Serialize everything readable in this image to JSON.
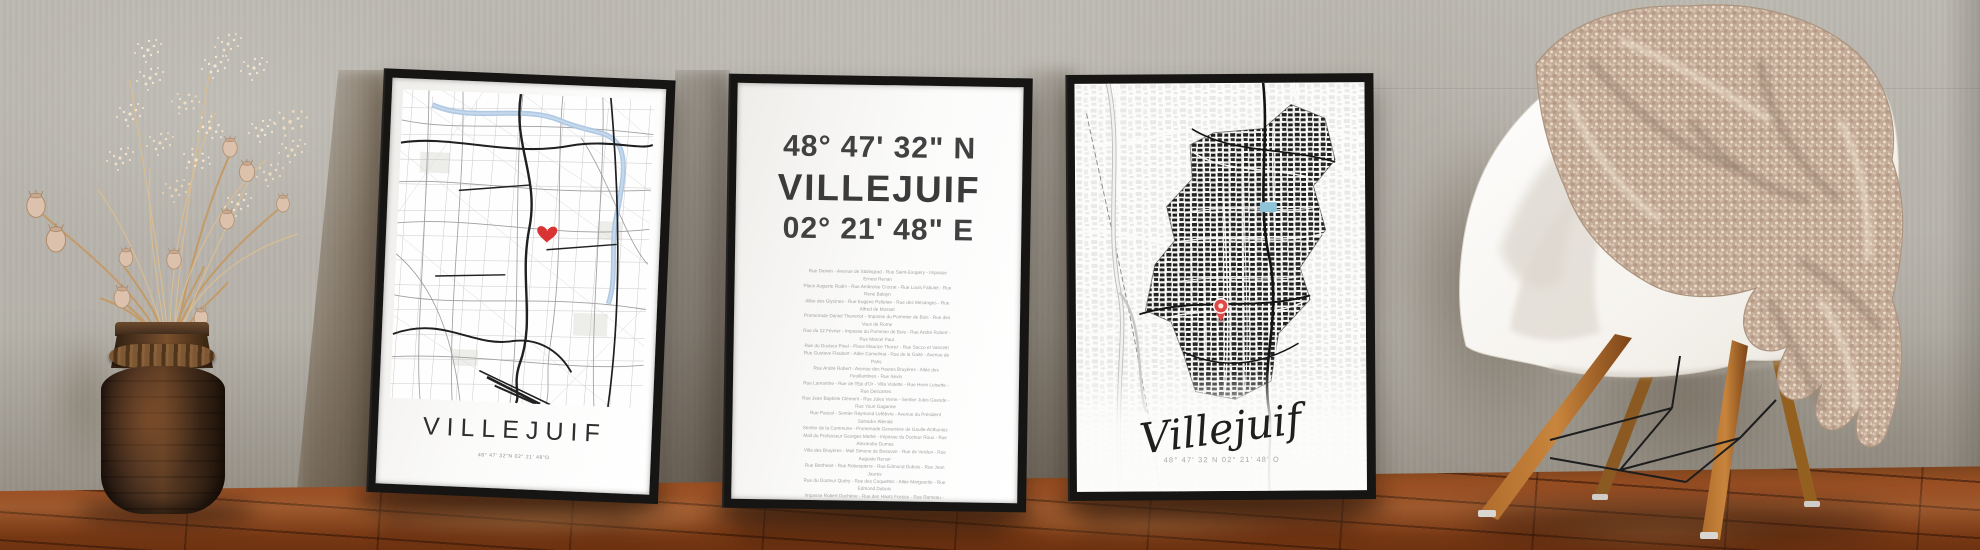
{
  "scene": {
    "caption": "Three framed Villejuif map posters leaning against a concrete wall, dried flowers in a wooden vase, white shell chair with a knit throw blanket on a wooden floor"
  },
  "poster_left": {
    "title": "VILLEJUIF",
    "coordinates": "48° 47' 32\"N 02° 21' 48\"O",
    "marker_icon": "heart-icon",
    "marker_color": "#d93333",
    "river_color": "#abc5e1"
  },
  "poster_center": {
    "latitude": "48° 47' 32\" N",
    "title": "VILLEJUIF",
    "longitude": "02° 21' 48\" E",
    "street_lines": [
      "Rue Darwin - Avenue de Stalingrad - Rue Saint-Exupéry - Impasse Ernest Renan",
      "Place Auguste Rodin - Rue Ambroise Croizat - Rue Louis Fabulet - Rue René Balayn",
      "Allée des Glycines - Rue Eugène Pelletan - Rue des Mésanges - Rue Alfred de Musset",
      "Promenade Daniel Thevenot - Impasse du Pommier de Bois - Rue des Vaux de Rome",
      "Rue du 12 Février - Impasse du Pommier de Bois - Rue André Robert - Rue Marcel Paul",
      "Rue du Docteur Pinel - Place Maurice Thorez - Rue Sacco et Vanzetti",
      "Rue Gustave Flaubert - Allée Camelinat - Rue de la Gaité - Avenue de Paris",
      "Rue André Robert - Avenue des Hautes Bruyères - Allée des Feuillantines - Rue Sévin",
      "Rue Lamartine - Rue de l'Épi d'Or - Villa Violette - Rue Henri Luisette - Rue Descartes",
      "Rue Jean Baptiste Clément - Rue Jules Verne - Sentier Jules Guesde - Rue Youri Gagarine",
      "Rue Pascal - Sentier Raymond Lefèbvre - Avenue du Président Salvador Allende",
      "Sentier de la Commune - Promenade Geneviève de Gaulle-Anthonioz",
      "Mail du Professeur Georges Mathé - Impasse du Docteur Roux - Rue Alexandre Dumas",
      "Villa des Bruyères - Mail Simone de Beauvoir - Rue de Verdun - Rue Auguste Renoir",
      "Rue Berthelot - Rue Robespierre - Rue Edmond Dubois - Rue Jean Jaurès",
      "Rue du Docteur Quéry - Rue des Coquettes - Allée Marguerite - Rue Edmond Dubois",
      "Impasse Robert Duchêne - Rue des Hauts Fossés - Rue Rameau - Rue Sainte-Colombe",
      "Rue Sévin - Rue Rosa Luxembourg - Allée Sonia Delaunay",
      "Promenade Geneviève de Gaulle-Anthonioz - Impasse des Lozaits - Rue François Billoux",
      "Rue Émile Gœury - Allée des Feuillantines - Allée des Pinsons - Rue Louise Michel",
      "Rue René Hamon - Boulevard Paul Vaillant-Couturier - Rue Sévin - Allée des Bosquets",
      "Villa du Commandant Louis Bouchet - Villa du Belvédère - Rue Eugène Pelletan"
    ]
  },
  "poster_right": {
    "title": "Villejuif",
    "coordinates": "48° 47' 32 N 02° 21' 48' O",
    "marker_icon": "map-pin-icon",
    "marker_color": "#e04848",
    "pool_color": "#8fc3d8"
  },
  "colors": {
    "frame": "#161513",
    "wall": "#b7b3ab",
    "floor": "#8a4520",
    "chair_shell": "#f4f1ec",
    "blanket": "#c3aa96",
    "vase": "#4a3120"
  }
}
